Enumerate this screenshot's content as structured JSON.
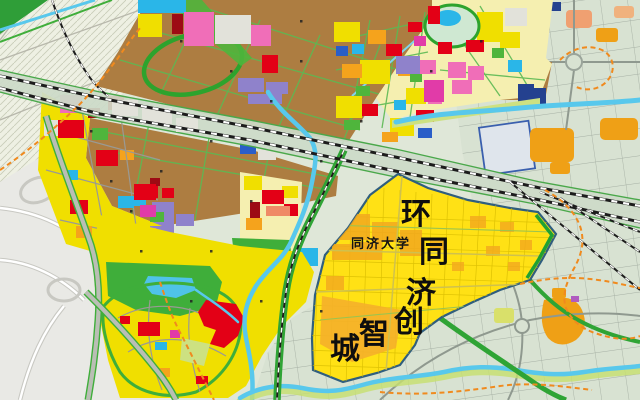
{
  "map": {
    "type": "urban-master-plan-map",
    "overlay": {
      "district_name": "环同济创智城",
      "chars": [
        {
          "ch": "环"
        },
        {
          "ch": "同"
        },
        {
          "ch": "济"
        },
        {
          "ch": "创"
        },
        {
          "ch": "智"
        },
        {
          "ch": "城"
        }
      ],
      "campus_label": "同济大学"
    },
    "palette": {
      "highlight_zone_yellow": "#ffe115",
      "residential_yellow": "#f0df00",
      "industrial_brown": "#ad7d41",
      "commercial_red": "#e30016",
      "mixed_use_pink": "#f06eb8",
      "culture_magenta": "#e13ba8",
      "education_purple": "#8f82cb",
      "water_cyan": "#58c8ec",
      "green_space": "#3fae3a",
      "civic_blue": "#2a5ec8",
      "office_orange": "#f3a81f",
      "planning_boundary_orange_dash": "#f08a1e",
      "railway_black": "#1c1c1c",
      "existing_city_gray_green": "#d8e2d2"
    }
  }
}
